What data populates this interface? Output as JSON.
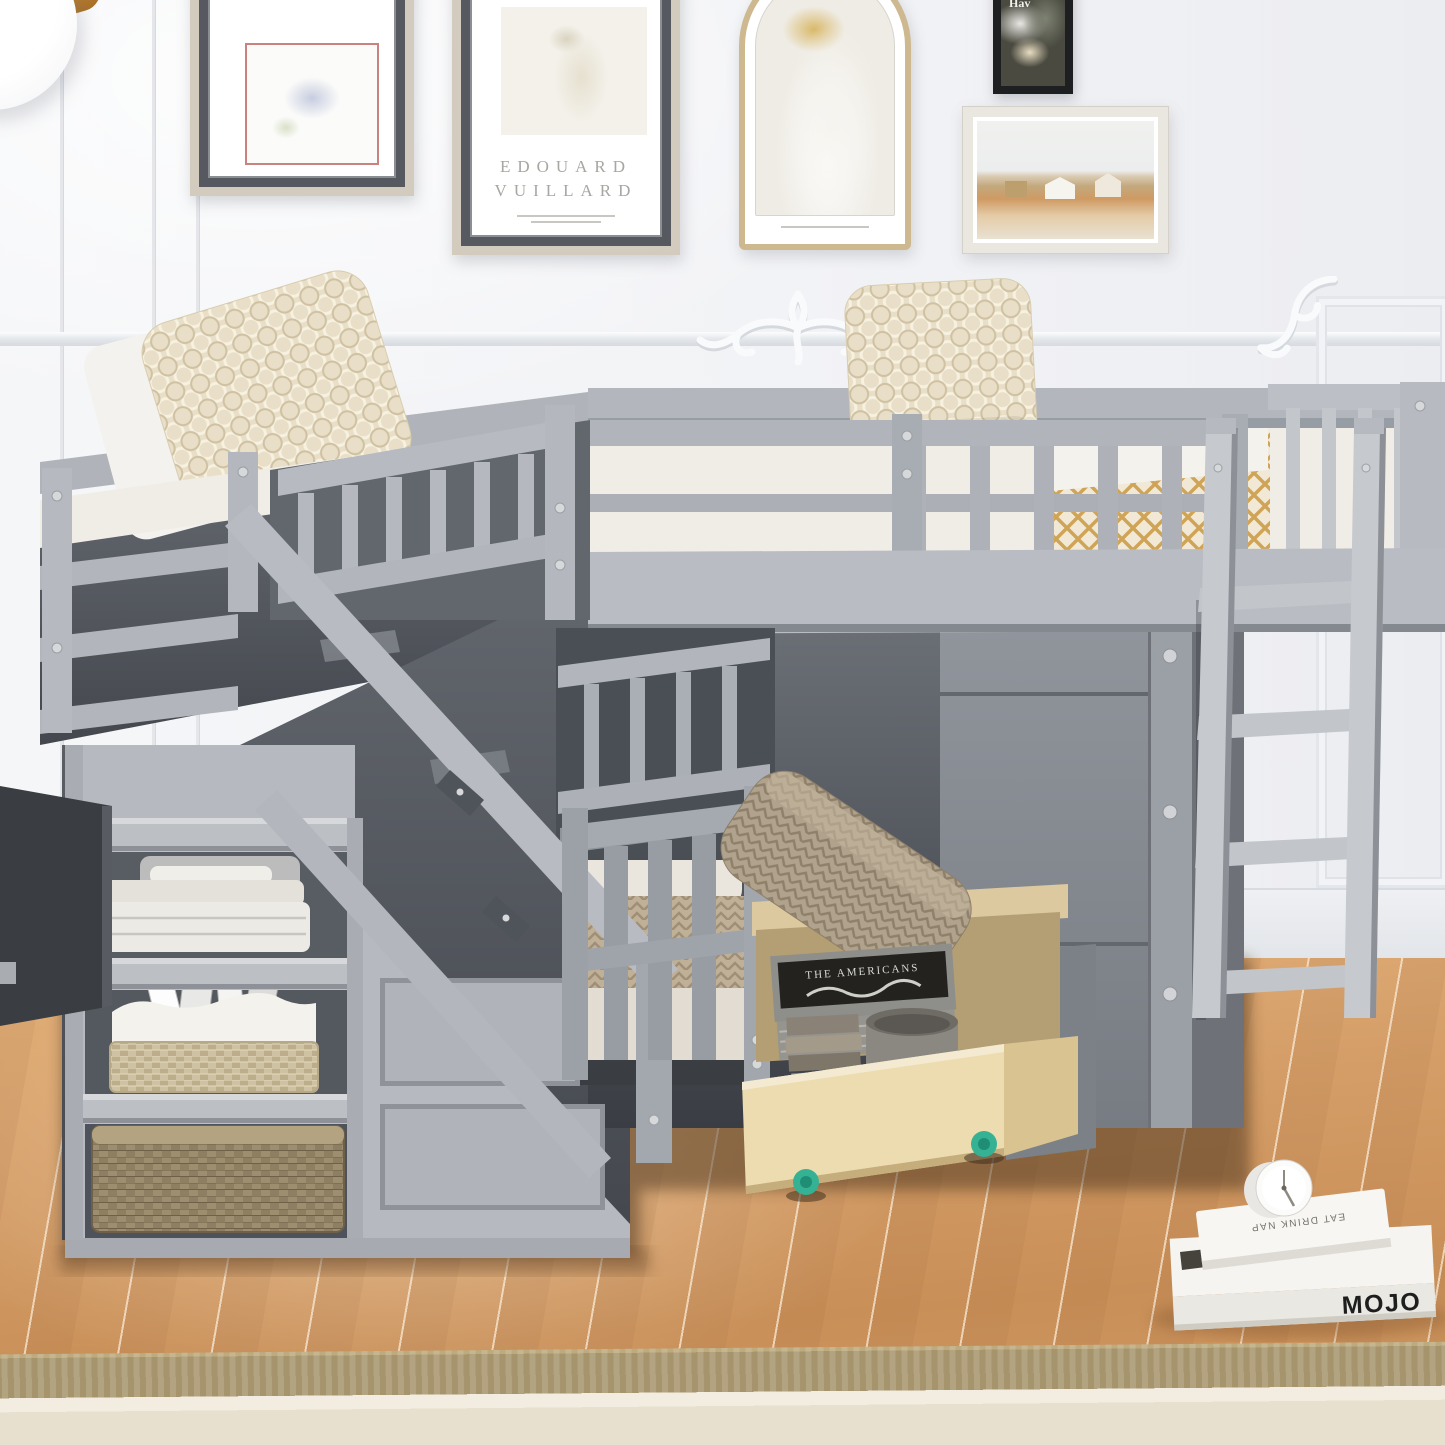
{
  "meta": {
    "description": "Product photo: gray twin-over-twin L-shaped loft bunk bed with storage staircase, shelf cubbies, rolling under-bed drawers and ladder, in a bright room with paneled walls, gallery wall art, oak floor and a rug"
  },
  "palette": {
    "bed_gray": "#b4b8be",
    "bed_gray_deep": "#7f848b",
    "wall": "#f2f3f6",
    "floor_wood": "#d19a63",
    "rug_border": "#a6946c",
    "rug_field": "#e7e0ce",
    "drawer_wood": "#ecdcb0",
    "wheel_teal": "#35b193",
    "basket_tan": "#9d8e70",
    "pillow_cream": "#e9dfc8"
  },
  "wall_art": {
    "vuillard_frame": {
      "artist_line1": "EDOUARD",
      "artist_line2": "VUILLARD"
    },
    "black_frame": {
      "caption": "Hav"
    }
  },
  "objects": {
    "drawer_book_title": "THE AMERICANS",
    "floor_book_top_spine": "EAT DRINK NAP",
    "floor_book_bottom_spine": "MOJO"
  }
}
